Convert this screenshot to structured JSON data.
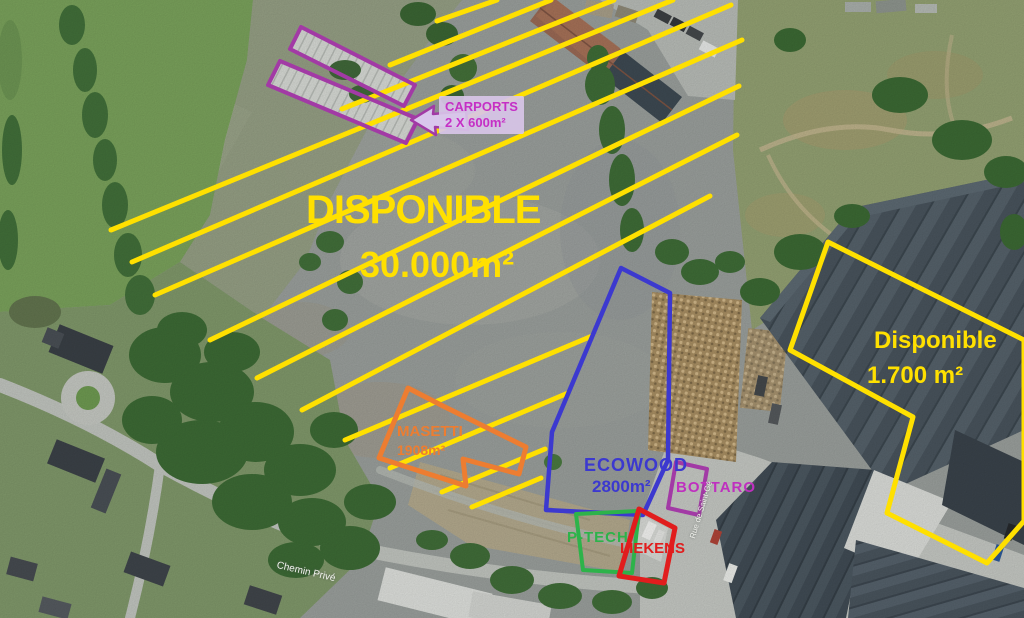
{
  "map": {
    "description": "Annotated aerial view of an industrial site with available plots",
    "colors": {
      "available_yellow": "#ffe000",
      "carports_purple": "#a23aa5",
      "carports_text": "#c52fc5",
      "masetti_orange": "#ed7d31",
      "ecowood_blue": "#3c39cf",
      "bottaro_magenta": "#bf30bf",
      "ptech_green": "#2db34a",
      "liekens_red": "#e11d1d"
    },
    "zones": {
      "main_available": {
        "title": "DISPONIBLE",
        "area": "30.000m²"
      },
      "carports": {
        "name": "CARPORTS",
        "detail": "2 X 600m²"
      },
      "masetti": {
        "name": "MASETTI",
        "area": "1908m²"
      },
      "ecowood": {
        "name": "ECOWOOD",
        "area": "2800m²"
      },
      "bottaro": {
        "name": "BOTTARO"
      },
      "ptech": {
        "name": "P-TECH"
      },
      "liekens": {
        "name": "LIEKENS"
      },
      "right_available": {
        "title": "Disponible",
        "area": "1.700 m²"
      }
    },
    "streets": {
      "chemin_prive": "Chemin Privé",
      "rue_saint": "Rue de Saint-Gé"
    }
  }
}
